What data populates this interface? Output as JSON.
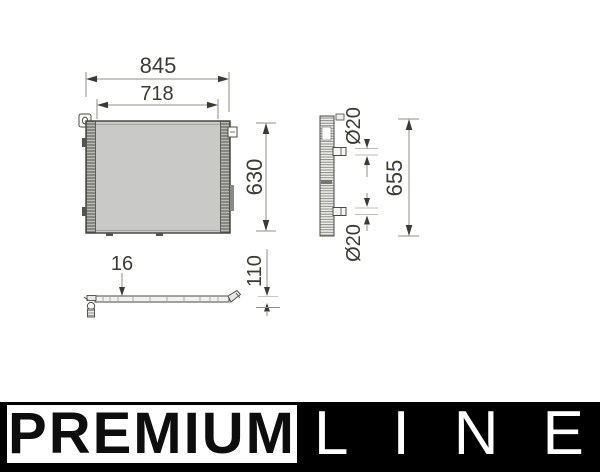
{
  "drawing": {
    "front_view": {
      "dims": {
        "outer_width": "845",
        "core_width": "718",
        "height": "630"
      }
    },
    "side_view": {
      "dims": {
        "top_port_diameter": "Ø20",
        "bottom_port_diameter": "Ø20",
        "height": "655"
      }
    },
    "bottom_view": {
      "dims": {
        "thickness": "16",
        "depth": "110"
      }
    }
  },
  "banner": {
    "premium": "PREMIUM",
    "line": "LINE"
  },
  "colors": {
    "banner_background": "#000000",
    "premium_box_background": "#ffffff",
    "dimension_text": "#3b3b33",
    "dimension_line": "#8f8f86",
    "part_outline": "#4a4a45",
    "core_fill": "#c9c9c7"
  }
}
